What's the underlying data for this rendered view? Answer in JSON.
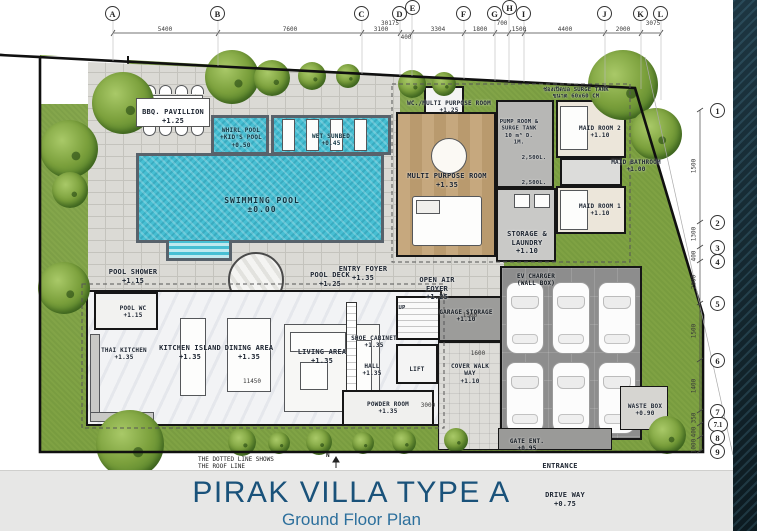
{
  "title": {
    "main": "PIRAK VILLA TYPE  A",
    "subtitle": "Ground Floor Plan"
  },
  "grid": {
    "top": [
      "A",
      "B",
      "C",
      "D",
      "E",
      "F",
      "G",
      "H",
      "I",
      "J",
      "K",
      "L"
    ],
    "right": [
      "1",
      "2",
      "3",
      "4",
      "5",
      "6",
      "7",
      "7.1",
      "8",
      "9"
    ]
  },
  "dims": {
    "overall": "30175",
    "top": [
      "5400",
      "7600",
      "3100",
      "400",
      "3304",
      "1800",
      "700",
      "1500",
      "4400",
      "2000",
      "3075"
    ],
    "right": [
      "1500",
      "1300",
      "400",
      "2000",
      "1500",
      "1400",
      "350",
      "400",
      "1000"
    ],
    "minor": [
      "11450",
      "1600",
      "3000",
      "1500"
    ]
  },
  "rooms": {
    "bbq": {
      "name": "BBQ. PAVILLION",
      "level": "+1.25"
    },
    "whirl": {
      "name": "WHIRL POOL\n+KID'S POOL",
      "level": "+0.50"
    },
    "wet_sunbed": {
      "name": "WET SUNBED",
      "level": "+0.45"
    },
    "pool": {
      "name": "SWIMMING POOL",
      "level": "±0.00"
    },
    "wc_multi": {
      "name": "WC./MULTI PURPOSE ROOM",
      "level": "+1.25"
    },
    "multi": {
      "name": "MULTI PURPOSE ROOM",
      "level": "+1.35"
    },
    "pump": {
      "name": "PUMP ROOM & SURGE TANK",
      "detail": "10 m³ D. 1M."
    },
    "maid2": {
      "name": "MAID ROOM 2",
      "level": "+1.10"
    },
    "maid1": {
      "name": "MAID ROOM 1",
      "level": "+1.10"
    },
    "maid_bath": {
      "name": "MAID BATHROOM",
      "level": "+1.00"
    },
    "storage": {
      "name": "STORAGE & LAUNDRY",
      "level": "+1.10"
    },
    "pool_shower": {
      "name": "POOL SHOWER",
      "level": "+1.15"
    },
    "pool_deck": {
      "name": "POOL DECK",
      "level": "+1.25"
    },
    "entry_foyer": {
      "name": "ENTRY FOYER",
      "level": "+1.35"
    },
    "open_air": {
      "name": "OPEN AIR FOYER",
      "level": "+1.25"
    },
    "pool_wc": {
      "name": "POOL WC",
      "level": "+1.15"
    },
    "thai_kitchen": {
      "name": "THAI KITCHEN",
      "level": "+1.35"
    },
    "kitchen_island": {
      "name": "KITCHEN ISLAND",
      "level": "+1.35"
    },
    "dining": {
      "name": "DINING AREA",
      "level": "+1.35"
    },
    "living": {
      "name": "LIVING AREA",
      "level": "+1.35"
    },
    "shoe": {
      "name": "SHOE CABINET",
      "level": "+1.35"
    },
    "hall": {
      "name": "HALL",
      "level": "+1.35"
    },
    "lift": {
      "name": "LIFT"
    },
    "garage_storage": {
      "name": "GARAGE STORAGE",
      "level": "+1.10"
    },
    "powder": {
      "name": "POWDER ROOM",
      "level": "+1.35"
    },
    "cover_walk": {
      "name": "COVER WALK WAY",
      "level": "+1.10"
    },
    "ev": {
      "name": "EV CHARGER",
      "detail": "(WALL BOX)"
    },
    "waste": {
      "name": "WASTE BOX",
      "level": "+0.90"
    },
    "gate": {
      "name": "GATE ENT.",
      "level": "+0.95"
    },
    "entrance": {
      "name": "ENTRANCE"
    },
    "driveway": {
      "name": "DRIVE WAY",
      "level": "+0.75"
    }
  },
  "ann": {
    "surge": "ช่องเปิดบ่อ SURGE TANK\nขนาด 60x60 CM",
    "tank1": "2,500L.",
    "tank2": "2,500L.",
    "up": "UP",
    "north": "N",
    "roof_note": "THE DOTTED LINE SHOWS\nTHE ROOF LINE"
  },
  "colors": {
    "title_blue": "#1a527a",
    "lawn_green": "#7fa243",
    "pool_blue": "#47bfd3",
    "paving_gray": "#dbdad5",
    "asphalt_gray": "#8d8d8d",
    "wood_tan": "#c6a87e",
    "band_navy": "#14272f"
  }
}
